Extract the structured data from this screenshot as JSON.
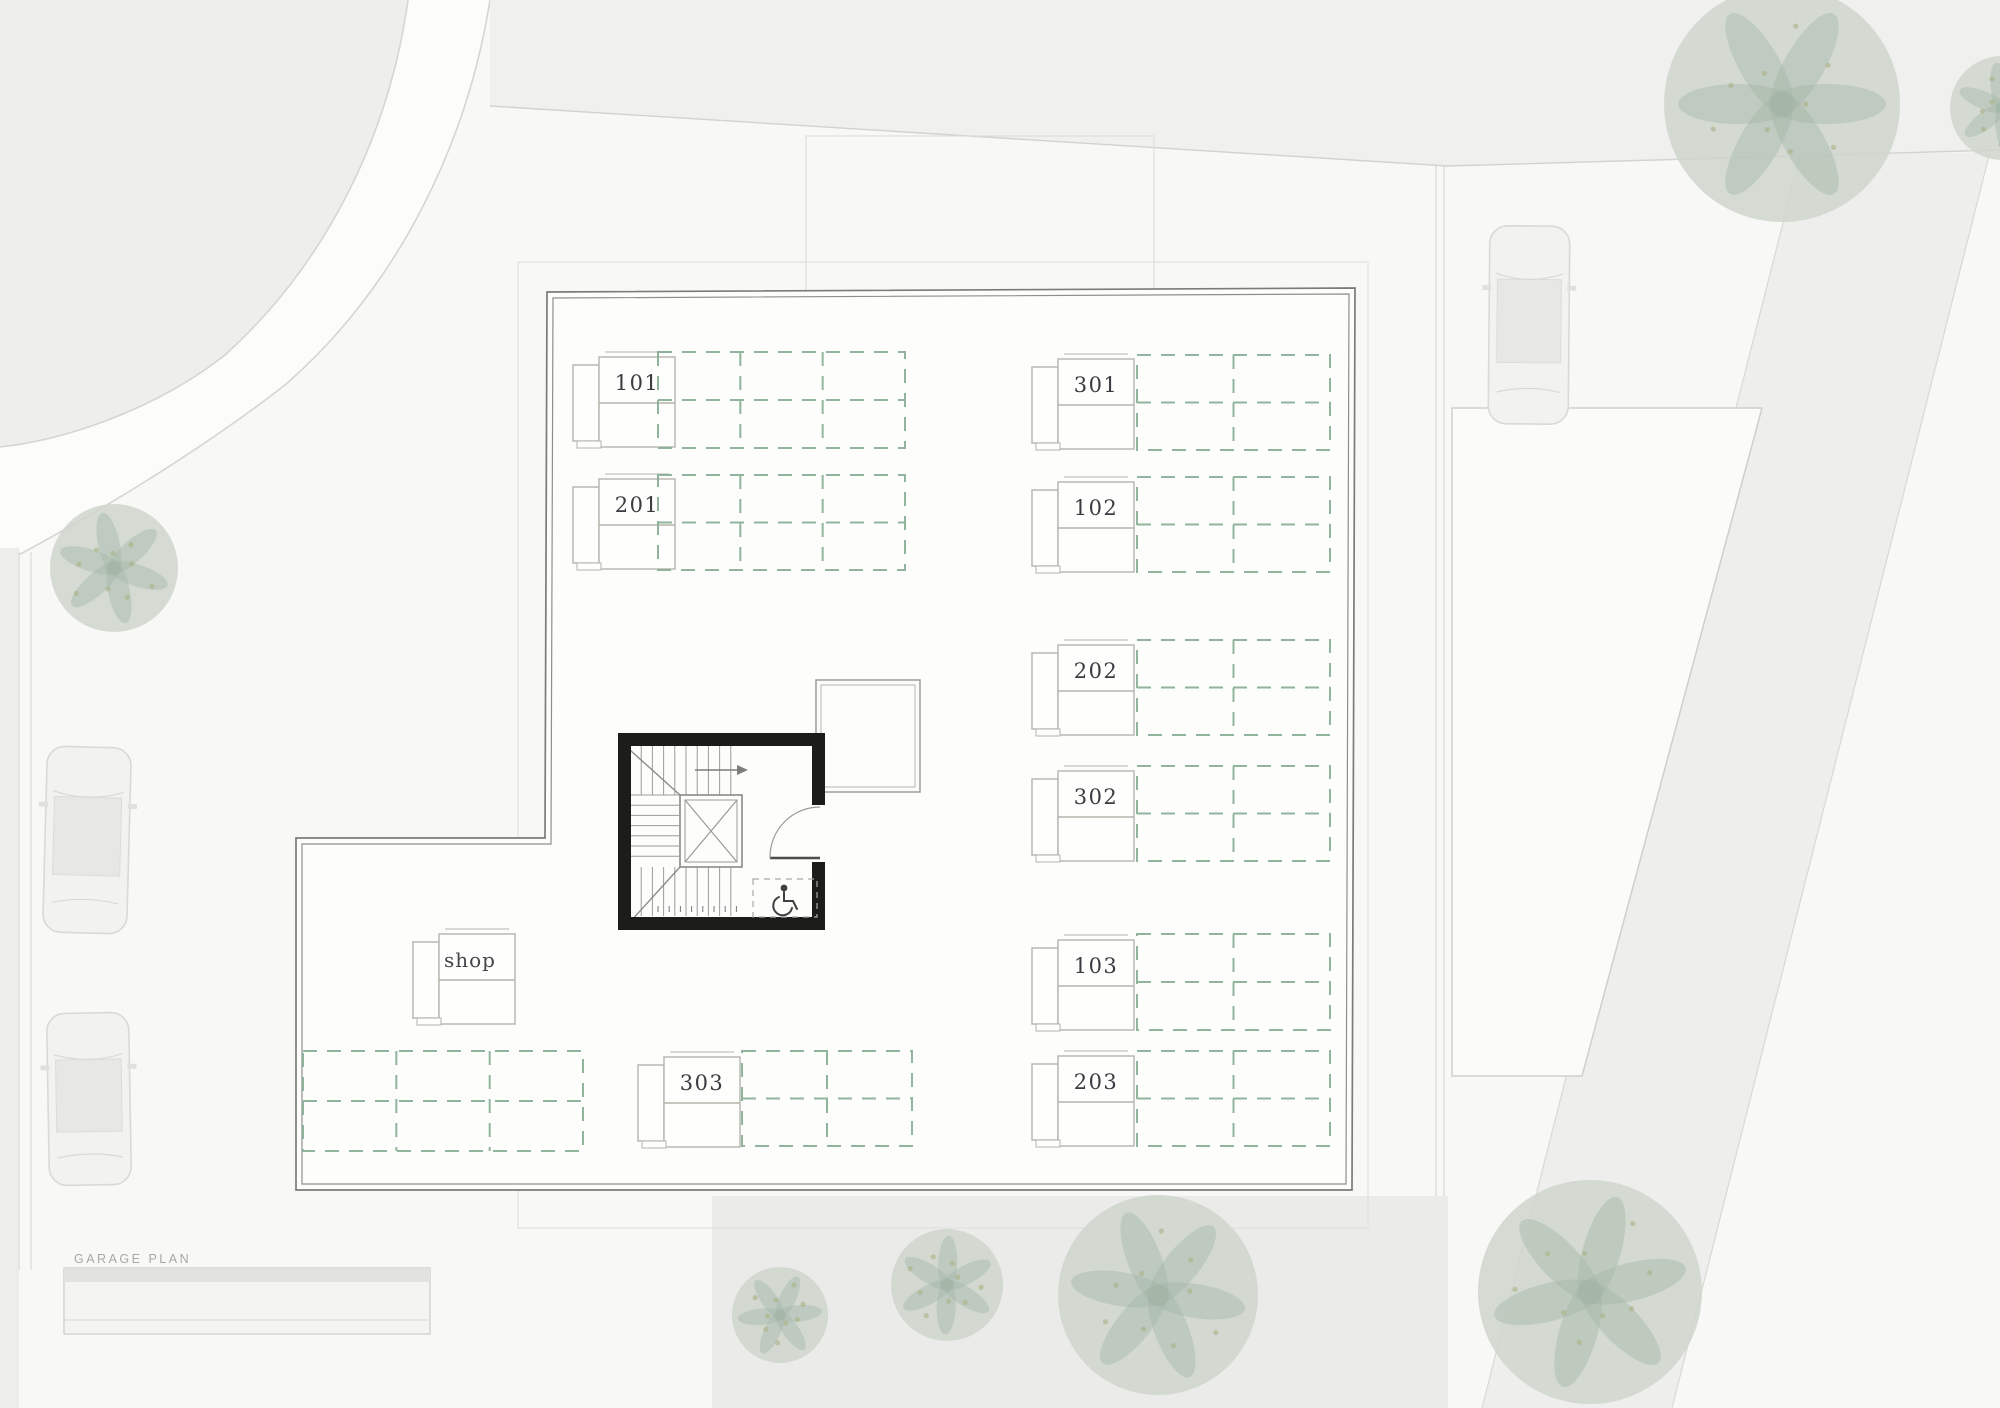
{
  "meta": {
    "plan_label": "GARAGE PLAN"
  },
  "units": [
    {
      "id": "101",
      "label": "101"
    },
    {
      "id": "201",
      "label": "201"
    },
    {
      "id": "301",
      "label": "301"
    },
    {
      "id": "102",
      "label": "102"
    },
    {
      "id": "202",
      "label": "202"
    },
    {
      "id": "302",
      "label": "302"
    },
    {
      "id": "103",
      "label": "103"
    },
    {
      "id": "203",
      "label": "203"
    },
    {
      "id": "303",
      "label": "303"
    },
    {
      "id": "shop",
      "label": "shop"
    }
  ],
  "icons": {
    "accessible": "wheelchair-icon"
  },
  "colors": {
    "paper": "#f0f0ee",
    "parcel": "#f8f8f7",
    "road": "#fcfcfb",
    "line": "#d2d2d0",
    "wall_outer": "#7c7c76",
    "wall_inner": "#8f8f89",
    "stair_wall": "#1c1c1a",
    "parking_dash": "#86ad93",
    "unit_box_stroke": "#b7b3ac",
    "courtyard": "#ebece9",
    "foliage_base": "#cfd6cc",
    "foliage_dark": "#a3b4a6",
    "foliage_olive": "#aab083",
    "car_body": "#f2f2f0",
    "car_stroke": "#d9d9d7",
    "pool": "#fbfbfa"
  }
}
